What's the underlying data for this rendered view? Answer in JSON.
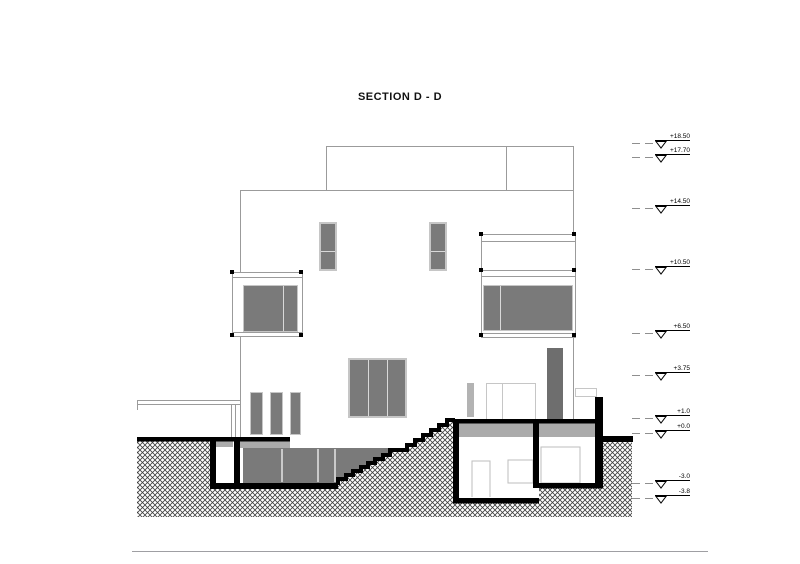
{
  "title": "SECTION D - D",
  "elevation_markers": [
    {
      "label": "+18.50"
    },
    {
      "label": "+17.70"
    },
    {
      "label": "+14.50"
    },
    {
      "label": "+10.50"
    },
    {
      "label": "+6.50"
    },
    {
      "label": "+3.75"
    },
    {
      "label": "+1.0"
    },
    {
      "label": "+0.0"
    },
    {
      "label": "-3.0"
    },
    {
      "label": "-3.8"
    }
  ],
  "colors": {
    "line_gray": "#9b9b9b",
    "glass_gray": "#7a7a7a",
    "slab_gray": "#ababab",
    "section_black": "#000000"
  }
}
